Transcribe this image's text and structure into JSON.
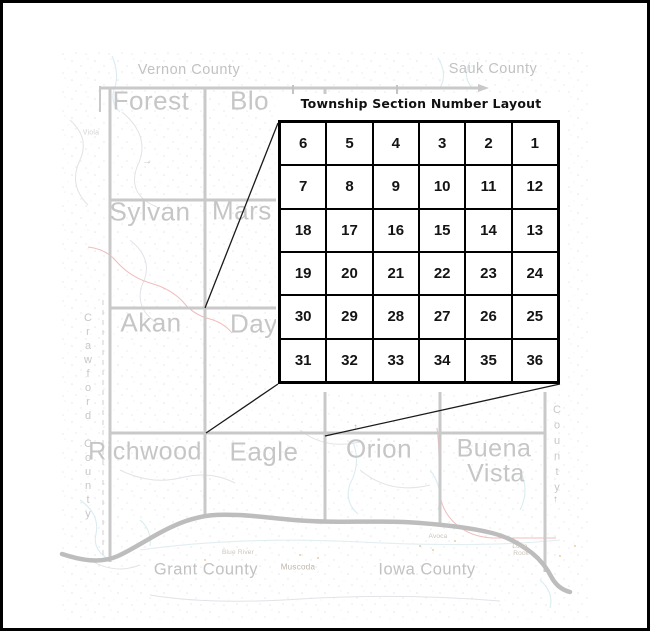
{
  "figure": {
    "title": "Township Section Number Layout"
  },
  "section_grid": {
    "rows": [
      [
        6,
        5,
        4,
        3,
        2,
        1
      ],
      [
        7,
        8,
        9,
        10,
        11,
        12
      ],
      [
        18,
        17,
        16,
        15,
        14,
        13
      ],
      [
        19,
        20,
        21,
        22,
        23,
        24
      ],
      [
        30,
        29,
        28,
        27,
        26,
        25
      ],
      [
        31,
        32,
        33,
        34,
        35,
        36
      ]
    ]
  },
  "map": {
    "townships": {
      "forest": "Forest",
      "bloom_partial": "Blo",
      "sylvan": "Sylvan",
      "marshall_partial": "Mars",
      "akan": "Akan",
      "dayton_partial": "Day",
      "richwood": "Richwood",
      "eagle": "Eagle",
      "orion": "Orion",
      "buena_vista_line1": "Buena",
      "buena_vista_line2": "Vista"
    },
    "counties": {
      "vernon": "Vernon County",
      "sauk": "Sauk County",
      "crawford_vertical": "Crawford County",
      "east_vertical": "County",
      "grant": "Grant County",
      "iowa": "Iowa County"
    },
    "places": {
      "viola": "Viola",
      "muscoda": "Muscoda",
      "blue_river": "Blue River",
      "avoca": "Avoca",
      "lone_rock_line1": "Lone",
      "lone_rock_line2": "Rock"
    }
  },
  "colors": {
    "frame_border": "#000000",
    "boundary_gray": "#c9c9c9",
    "river_gray": "#bdbdbd",
    "highway_red": "#f1bcbc",
    "stream_blue": "#d9edf1",
    "label_gray": "#c4c4c4",
    "grid_line": "#000000"
  }
}
